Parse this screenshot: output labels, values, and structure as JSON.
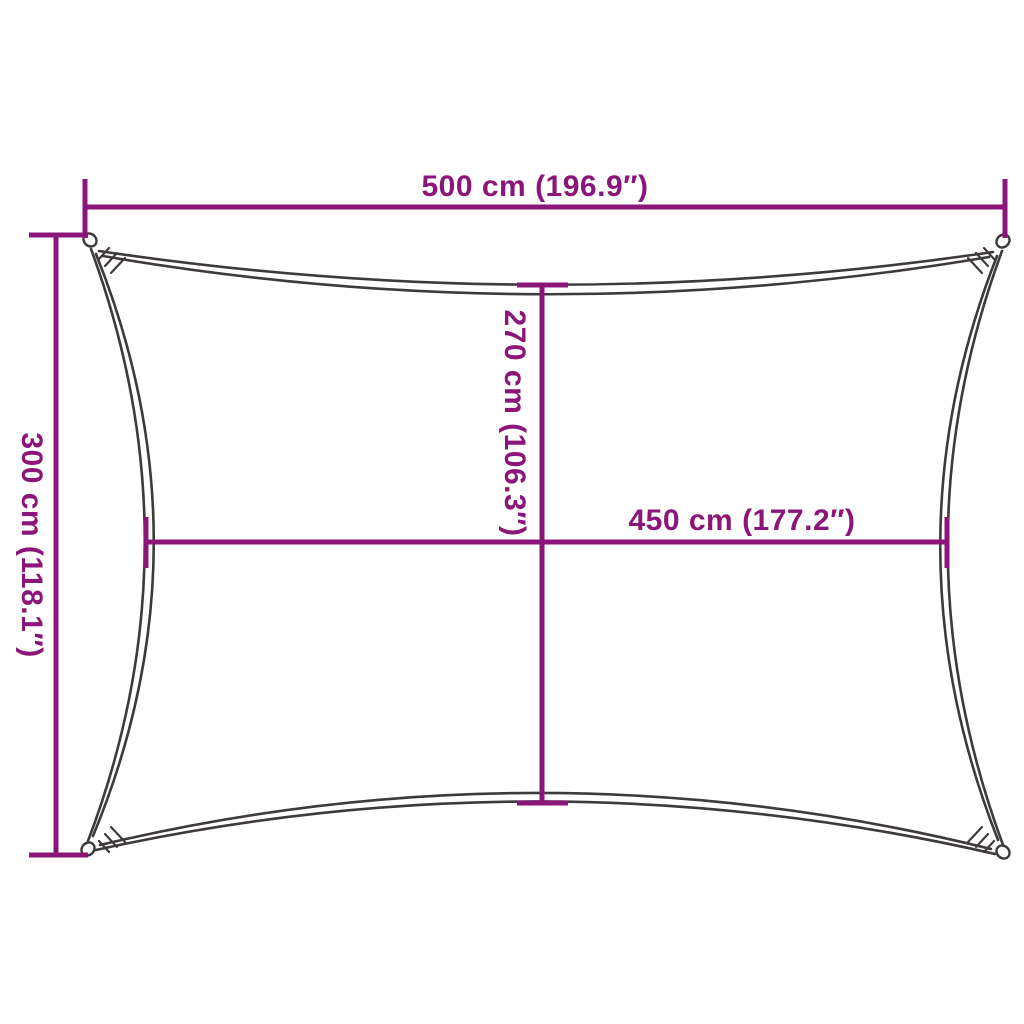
{
  "diagram": {
    "title": "Shade sail dimension diagram",
    "background": "#ffffff",
    "colors": {
      "dimension": "#8B1578",
      "outline": "#3E3A3C",
      "loop_fill": "#ffffff"
    },
    "dimensions": {
      "top_width": {
        "label": "500 cm (196.9″)",
        "cm": 500,
        "inches": 196.9
      },
      "left_height": {
        "label": "300 cm (118.1″)",
        "cm": 300,
        "inches": 118.1
      },
      "center_height": {
        "label": "270 cm (106.3″)",
        "cm": 270,
        "inches": 106.3
      },
      "center_width": {
        "label": "450 cm (177.2″)",
        "cm": 450,
        "inches": 177.2
      }
    }
  }
}
